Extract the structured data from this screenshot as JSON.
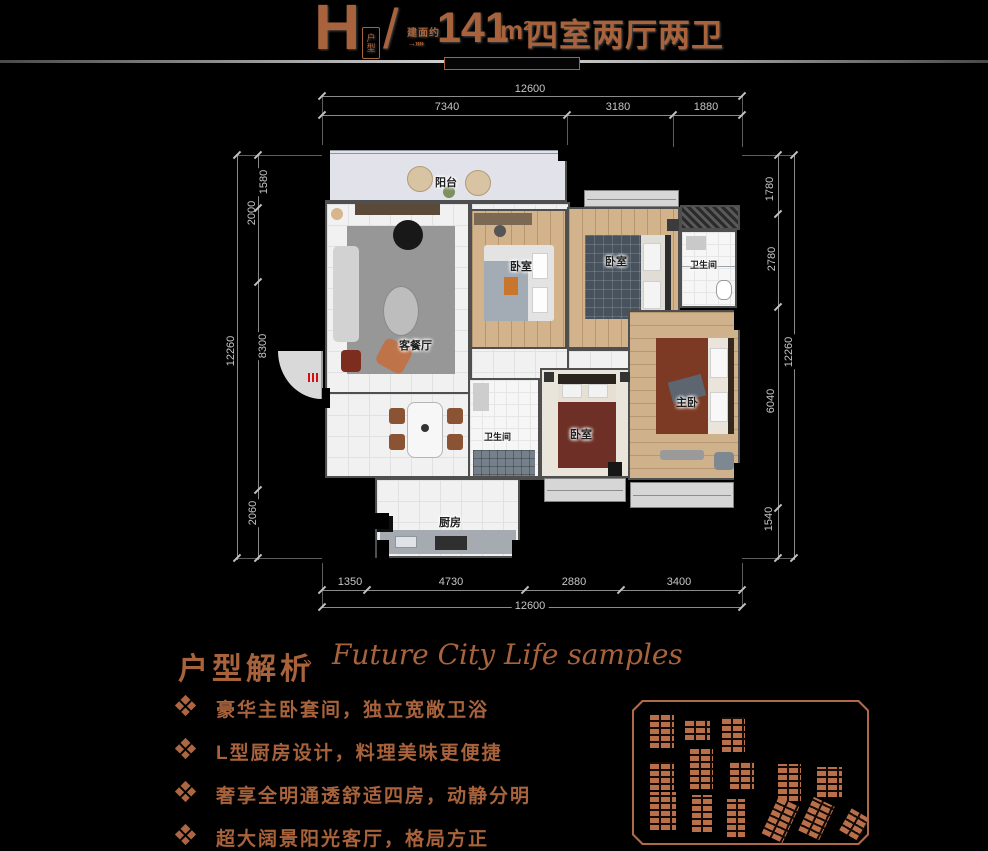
{
  "title": {
    "unit_letter": "H",
    "unit_label": "户型",
    "slash": "/",
    "area_prefix": "建面约",
    "area_arrow": "→»»",
    "area_value": "141",
    "area_unit": "m²",
    "rooms_text": "四室两厅两卫"
  },
  "floorplan": {
    "rooms": {
      "balcony": "阳台",
      "living": "客餐厅",
      "bedroom_top": "卧室",
      "bedroom_right": "卧室",
      "bath_top": "卫生间",
      "bath_mid": "卫生间",
      "bedroom_bottom": "卧室",
      "master": "主卧",
      "kitchen": "厨房"
    },
    "dims": {
      "top_total": "12600",
      "top_seg": [
        "7340",
        "3180",
        "1880"
      ],
      "bottom_total": "12600",
      "bottom_seg": [
        "1350",
        "4730",
        "2880",
        "3400"
      ],
      "left_total": "12260",
      "left_seg": [
        "1580",
        "2000",
        "8300",
        "2060"
      ],
      "right_total": "12260",
      "right_seg": [
        "1780",
        "2780",
        "6040",
        "1540"
      ]
    }
  },
  "analysis": {
    "heading": "户型解析",
    "arrow": "»",
    "subtitle_script": "Future City Life samples",
    "bullets": [
      "豪华主卧套间，独立宽敞卫浴",
      "L型厨房设计，料理美味更便捷",
      "奢享全明通透舒适四房，动静分明",
      "超大阔景阳光客厅，格局方正"
    ]
  },
  "colors": {
    "background": "#000000",
    "copper": "#a8633c",
    "dimension_text": "#c6c6c6",
    "wall": "#4f4f4f",
    "wood_floor": "#d2b38c",
    "site_building": "#b96f4a",
    "red_marker": "#d40f0f"
  }
}
